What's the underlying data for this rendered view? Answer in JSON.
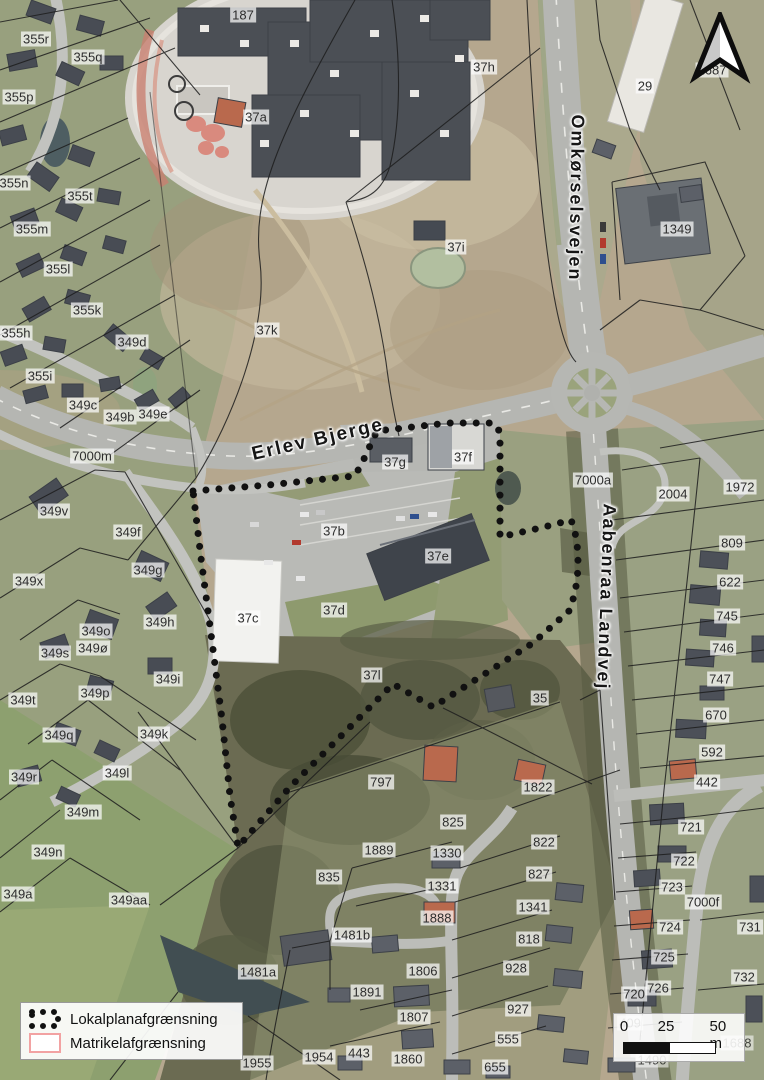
{
  "map": {
    "title": "Lokalplan oversigtskort",
    "road_labels": [
      {
        "text": "Erlev Bjerge",
        "x": 318,
        "y": 440,
        "rotate": -13,
        "size": 19
      },
      {
        "text": "Omkørselsvejen",
        "x": 576,
        "y": 198,
        "rotate": 91,
        "size": 18
      },
      {
        "text": "Aabenraa Landvej",
        "x": 606,
        "y": 597,
        "rotate": 92,
        "size": 18
      }
    ],
    "parcel_labels": [
      {
        "text": "187",
        "x": 243,
        "y": 15
      },
      {
        "text": "355r",
        "x": 36,
        "y": 39
      },
      {
        "text": "355q",
        "x": 88,
        "y": 57
      },
      {
        "text": "355p",
        "x": 19,
        "y": 97
      },
      {
        "text": "37a",
        "x": 256,
        "y": 117
      },
      {
        "text": "37h",
        "x": 484,
        "y": 67
      },
      {
        "text": "29",
        "x": 645,
        "y": 86
      },
      {
        "text": "1687",
        "x": 712,
        "y": 70
      },
      {
        "text": "355n",
        "x": 14,
        "y": 183
      },
      {
        "text": "355t",
        "x": 80,
        "y": 196
      },
      {
        "text": "355m",
        "x": 32,
        "y": 229
      },
      {
        "text": "1349",
        "x": 677,
        "y": 229
      },
      {
        "text": "37i",
        "x": 456,
        "y": 247
      },
      {
        "text": "355l",
        "x": 58,
        "y": 269
      },
      {
        "text": "355k",
        "x": 87,
        "y": 310
      },
      {
        "text": "355h",
        "x": 16,
        "y": 333
      },
      {
        "text": "349d",
        "x": 132,
        "y": 342
      },
      {
        "text": "37k",
        "x": 267,
        "y": 330
      },
      {
        "text": "355i",
        "x": 40,
        "y": 376
      },
      {
        "text": "349c",
        "x": 83,
        "y": 405
      },
      {
        "text": "349b",
        "x": 120,
        "y": 417
      },
      {
        "text": "349e",
        "x": 153,
        "y": 414
      },
      {
        "text": "7000m",
        "x": 92,
        "y": 456
      },
      {
        "text": "37g",
        "x": 395,
        "y": 462
      },
      {
        "text": "37f",
        "x": 463,
        "y": 457
      },
      {
        "text": "7000a",
        "x": 593,
        "y": 480
      },
      {
        "text": "1972",
        "x": 740,
        "y": 487
      },
      {
        "text": "2004",
        "x": 673,
        "y": 494
      },
      {
        "text": "349v",
        "x": 54,
        "y": 511
      },
      {
        "text": "349f",
        "x": 128,
        "y": 532
      },
      {
        "text": "37b",
        "x": 334,
        "y": 531
      },
      {
        "text": "809",
        "x": 732,
        "y": 543
      },
      {
        "text": "37e",
        "x": 438,
        "y": 556
      },
      {
        "text": "349g",
        "x": 148,
        "y": 570
      },
      {
        "text": "349x",
        "x": 29,
        "y": 581
      },
      {
        "text": "622",
        "x": 730,
        "y": 582
      },
      {
        "text": "37d",
        "x": 334,
        "y": 610
      },
      {
        "text": "37c",
        "x": 248,
        "y": 618
      },
      {
        "text": "349h",
        "x": 160,
        "y": 622
      },
      {
        "text": "745",
        "x": 727,
        "y": 616
      },
      {
        "text": "349o",
        "x": 96,
        "y": 631
      },
      {
        "text": "349ø",
        "x": 93,
        "y": 648
      },
      {
        "text": "349s",
        "x": 55,
        "y": 653
      },
      {
        "text": "746",
        "x": 723,
        "y": 648
      },
      {
        "text": "37l",
        "x": 372,
        "y": 675
      },
      {
        "text": "349i",
        "x": 168,
        "y": 679
      },
      {
        "text": "747",
        "x": 720,
        "y": 679
      },
      {
        "text": "349p",
        "x": 95,
        "y": 693
      },
      {
        "text": "35",
        "x": 540,
        "y": 698
      },
      {
        "text": "349t",
        "x": 23,
        "y": 700
      },
      {
        "text": "670",
        "x": 716,
        "y": 715
      },
      {
        "text": "349k",
        "x": 154,
        "y": 734
      },
      {
        "text": "349q",
        "x": 59,
        "y": 735
      },
      {
        "text": "592",
        "x": 712,
        "y": 752
      },
      {
        "text": "349l",
        "x": 117,
        "y": 773
      },
      {
        "text": "349r",
        "x": 24,
        "y": 777
      },
      {
        "text": "797",
        "x": 381,
        "y": 782
      },
      {
        "text": "1822",
        "x": 538,
        "y": 787
      },
      {
        "text": "442",
        "x": 707,
        "y": 782
      },
      {
        "text": "349m",
        "x": 83,
        "y": 812
      },
      {
        "text": "825",
        "x": 453,
        "y": 822
      },
      {
        "text": "721",
        "x": 691,
        "y": 827
      },
      {
        "text": "822",
        "x": 544,
        "y": 842
      },
      {
        "text": "1889",
        "x": 379,
        "y": 850
      },
      {
        "text": "1330",
        "x": 447,
        "y": 853
      },
      {
        "text": "349n",
        "x": 48,
        "y": 852
      },
      {
        "text": "722",
        "x": 684,
        "y": 861
      },
      {
        "text": "827",
        "x": 539,
        "y": 874
      },
      {
        "text": "835",
        "x": 329,
        "y": 877
      },
      {
        "text": "1331",
        "x": 442,
        "y": 886
      },
      {
        "text": "723",
        "x": 672,
        "y": 887
      },
      {
        "text": "349a",
        "x": 18,
        "y": 894
      },
      {
        "text": "349aa",
        "x": 129,
        "y": 900
      },
      {
        "text": "1341",
        "x": 533,
        "y": 907
      },
      {
        "text": "7000f",
        "x": 703,
        "y": 902
      },
      {
        "text": "1888",
        "x": 437,
        "y": 918
      },
      {
        "text": "724",
        "x": 670,
        "y": 927
      },
      {
        "text": "731",
        "x": 750,
        "y": 927
      },
      {
        "text": "1481b",
        "x": 352,
        "y": 935
      },
      {
        "text": "818",
        "x": 529,
        "y": 939
      },
      {
        "text": "725",
        "x": 664,
        "y": 957
      },
      {
        "text": "928",
        "x": 516,
        "y": 968
      },
      {
        "text": "1806",
        "x": 423,
        "y": 971
      },
      {
        "text": "1481a",
        "x": 258,
        "y": 972
      },
      {
        "text": "732",
        "x": 744,
        "y": 977
      },
      {
        "text": "726",
        "x": 658,
        "y": 988
      },
      {
        "text": "1891",
        "x": 367,
        "y": 992
      },
      {
        "text": "927",
        "x": 518,
        "y": 1009
      },
      {
        "text": "1807",
        "x": 414,
        "y": 1017
      },
      {
        "text": "555",
        "x": 508,
        "y": 1039
      },
      {
        "text": "720",
        "x": 634,
        "y": 994
      },
      {
        "text": "409",
        "x": 630,
        "y": 1023,
        "faint": true
      },
      {
        "text": "1688",
        "x": 737,
        "y": 1043,
        "faint": true
      },
      {
        "text": "1490",
        "x": 652,
        "y": 1060,
        "faint": true
      },
      {
        "text": "1954",
        "x": 319,
        "y": 1057
      },
      {
        "text": "443",
        "x": 359,
        "y": 1053
      },
      {
        "text": "1955",
        "x": 257,
        "y": 1063
      },
      {
        "text": "1860",
        "x": 408,
        "y": 1059
      },
      {
        "text": "655",
        "x": 495,
        "y": 1067
      }
    ]
  },
  "legend": {
    "items": [
      {
        "label": "Lokalplanafgrænsning",
        "symbol": "dotted-boundary",
        "color": "#111111"
      },
      {
        "label": "Matrikelafgrænsning",
        "symbol": "outline-rect",
        "color": "#f2a2a2"
      }
    ]
  },
  "scalebar": {
    "tick0": "0",
    "tick1": "25",
    "tick2": "50 m"
  },
  "colors": {
    "boundary_dots": "#111111",
    "matrikel_line": "#f2a2a2",
    "label_background": "rgba(252,252,252,0.72)"
  }
}
